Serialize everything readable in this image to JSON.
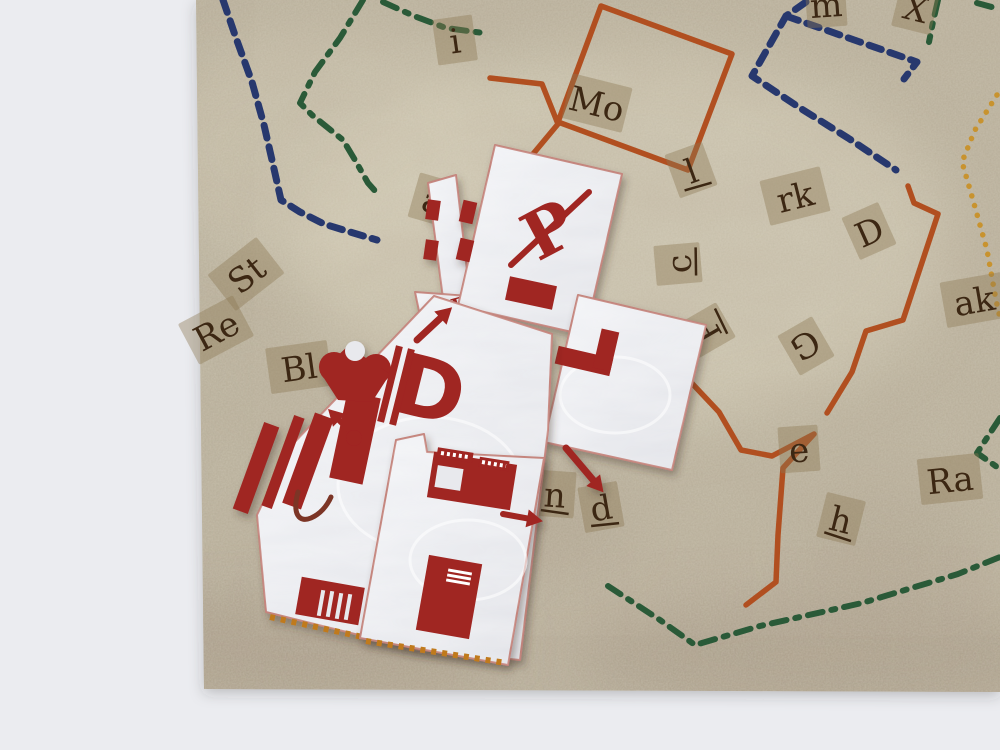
{
  "scene": {
    "description": "Photograph of a parchment treasure-map game board with colored route lines and cut-out letter tiles, overlaid with white papercraft puzzle pieces printed with dark red robot motifs, lying on a light gray table surface."
  },
  "colors": {
    "backdrop": "#ebecf0",
    "parchment": "#b7ae99",
    "parchment_light": "#d8d1bb",
    "shade": "#8d7c69",
    "tile_bg": "rgba(141,120,82,0.40)",
    "tile_text": "#3c2713",
    "piece_base": "#e8e9ed",
    "piece_edge": "#c4847c",
    "print_red": "#a02521",
    "print_dark": "#7c3526",
    "green": "#2a5a38",
    "navy": "#27386e",
    "orange": "#b14f20",
    "yellow": "#c8932f",
    "perforation": "#c07a1e"
  },
  "map": {
    "outline": [
      [
        196,
        0
      ],
      [
        1000,
        0
      ],
      [
        1000,
        692
      ],
      [
        204,
        689
      ]
    ],
    "shade_band": [
      [
        204,
        552
      ],
      [
        1000,
        545
      ],
      [
        1000,
        692
      ],
      [
        204,
        689
      ]
    ],
    "letter_tiles": [
      {
        "label": "m",
        "x": 826,
        "y": 4,
        "rot": -4
      },
      {
        "label": "X",
        "x": 916,
        "y": 8,
        "rot": 14
      },
      {
        "label": "i",
        "x": 455,
        "y": 40,
        "rot": -8
      },
      {
        "label": "Mo",
        "x": 597,
        "y": 103,
        "rot": 14
      },
      {
        "label": "l",
        "x": 691,
        "y": 170,
        "rot": -20,
        "ul": true
      },
      {
        "label": "rk",
        "x": 795,
        "y": 196,
        "rot": -14
      },
      {
        "label": "D",
        "x": 869,
        "y": 231,
        "rot": -24
      },
      {
        "label": "c",
        "x": 678,
        "y": 264,
        "rot": -95,
        "ul": true
      },
      {
        "label": "P",
        "x": 706,
        "y": 331,
        "rot": -120,
        "ul": true
      },
      {
        "label": "G",
        "x": 806,
        "y": 346,
        "rot": 150
      },
      {
        "label": "ak",
        "x": 974,
        "y": 300,
        "rot": -10
      },
      {
        "label": "a",
        "x": 433,
        "y": 200,
        "rot": 16
      },
      {
        "label": "St",
        "x": 246,
        "y": 274,
        "rot": -38
      },
      {
        "label": "Re",
        "x": 216,
        "y": 330,
        "rot": -28
      },
      {
        "label": "Bl",
        "x": 299,
        "y": 367,
        "rot": -8
      },
      {
        "label": "x",
        "x": 620,
        "y": 341,
        "rot": 36
      },
      {
        "label": "n",
        "x": 555,
        "y": 494,
        "rot": 4,
        "ul": true
      },
      {
        "label": "d",
        "x": 601,
        "y": 507,
        "rot": -10,
        "ul": true
      },
      {
        "label": "e",
        "x": 799,
        "y": 449,
        "rot": -4
      },
      {
        "label": "h",
        "x": 841,
        "y": 519,
        "rot": 14,
        "ul": true
      },
      {
        "label": "Ra",
        "x": 950,
        "y": 479,
        "rot": -6
      }
    ]
  },
  "paths": [
    {
      "name": "route-green-dashdot-a",
      "color": "green",
      "style": "dashdot",
      "w": 6,
      "pts": [
        [
          363,
          0
        ],
        [
          340,
          38
        ],
        [
          315,
          72
        ],
        [
          300,
          103
        ],
        [
          312,
          115
        ],
        [
          343,
          140
        ],
        [
          355,
          160
        ],
        [
          368,
          183
        ],
        [
          376,
          192
        ]
      ]
    },
    {
      "name": "route-green-dashdot-b",
      "color": "green",
      "style": "dashdot",
      "w": 6,
      "pts": [
        [
          383,
          2
        ],
        [
          414,
          16
        ],
        [
          446,
          28
        ],
        [
          483,
          33
        ]
      ]
    },
    {
      "name": "route-green-dashdot-c",
      "color": "green",
      "style": "dashdot",
      "w": 6,
      "pts": [
        [
          938,
          0
        ],
        [
          933,
          22
        ],
        [
          929,
          42
        ]
      ]
    },
    {
      "name": "route-green-dashdot-d",
      "color": "green",
      "style": "dashdot",
      "w": 6,
      "pts": [
        [
          977,
          3
        ],
        [
          999,
          9
        ]
      ]
    },
    {
      "name": "route-green-dashdot-e",
      "color": "green",
      "style": "dashdot",
      "w": 6,
      "pts": [
        [
          1000,
          418
        ],
        [
          977,
          453
        ],
        [
          997,
          467
        ]
      ]
    },
    {
      "name": "route-green-dashdot-f",
      "color": "green",
      "style": "dashdot",
      "w": 6,
      "pts": [
        [
          608,
          586
        ],
        [
          660,
          620
        ],
        [
          695,
          645
        ],
        [
          760,
          626
        ],
        [
          862,
          603
        ],
        [
          958,
          574
        ],
        [
          1000,
          557
        ]
      ]
    },
    {
      "name": "route-navy-dashed-a",
      "color": "navy",
      "style": "dashed",
      "w": 7,
      "pts": [
        [
          223,
          0
        ],
        [
          236,
          38
        ],
        [
          252,
          82
        ],
        [
          264,
          125
        ],
        [
          272,
          160
        ],
        [
          281,
          200
        ],
        [
          300,
          212
        ],
        [
          324,
          224
        ],
        [
          350,
          232
        ],
        [
          377,
          240
        ]
      ]
    },
    {
      "name": "route-navy-dashed-b",
      "color": "navy",
      "style": "dashed",
      "w": 7,
      "pts": [
        [
          806,
          2
        ],
        [
          786,
          16
        ],
        [
          752,
          76
        ],
        [
          800,
          108
        ],
        [
          848,
          138
        ],
        [
          896,
          170
        ]
      ]
    },
    {
      "name": "route-navy-dashed-c",
      "color": "navy",
      "style": "dashed",
      "w": 7,
      "pts": [
        [
          786,
          16
        ],
        [
          860,
          42
        ],
        [
          917,
          62
        ],
        [
          904,
          79
        ]
      ]
    },
    {
      "name": "route-orange-square",
      "color": "orange",
      "style": "solid",
      "w": 5.5,
      "pts": [
        [
          601,
          6
        ],
        [
          732,
          54
        ],
        [
          688,
          170
        ],
        [
          558,
          122
        ],
        [
          601,
          6
        ]
      ]
    },
    {
      "name": "route-orange-trail",
      "color": "orange",
      "style": "solid",
      "w": 5.5,
      "pts": [
        [
          490,
          78
        ],
        [
          542,
          84
        ],
        [
          558,
          124
        ],
        [
          518,
          172
        ],
        [
          548,
          262
        ],
        [
          588,
          327
        ],
        [
          648,
          341
        ],
        [
          672,
          347
        ],
        [
          686,
          377
        ],
        [
          719,
          412
        ],
        [
          741,
          450
        ],
        [
          772,
          456
        ],
        [
          814,
          434
        ],
        [
          783,
          468
        ],
        [
          778,
          535
        ],
        [
          776,
          582
        ],
        [
          746,
          605
        ]
      ]
    },
    {
      "name": "route-orange-zigzag",
      "color": "orange",
      "style": "solid",
      "w": 5.5,
      "pts": [
        [
          908,
          186
        ],
        [
          914,
          203
        ],
        [
          938,
          214
        ],
        [
          903,
          320
        ],
        [
          866,
          331
        ],
        [
          852,
          372
        ],
        [
          827,
          413
        ]
      ]
    },
    {
      "name": "route-yellow-dotted",
      "color": "yellow",
      "style": "dotted",
      "w": 5.5,
      "pts": [
        [
          997,
          95
        ],
        [
          975,
          130
        ],
        [
          962,
          162
        ],
        [
          973,
          200
        ],
        [
          987,
          250
        ],
        [
          996,
          300
        ],
        [
          1000,
          318
        ]
      ]
    }
  ],
  "pieces": [
    {
      "name": "paper-piece-sliver",
      "outline": [
        [
          428,
          183
        ],
        [
          456,
          175
        ],
        [
          470,
          296
        ],
        [
          444,
          306
        ]
      ],
      "decals": [
        {
          "n": "edge-notch",
          "t": "rect",
          "x": 433,
          "y": 210,
          "w": 13,
          "h": 20,
          "r": 8
        },
        {
          "n": "edge-notch",
          "t": "rect",
          "x": 431,
          "y": 250,
          "w": 13,
          "h": 20,
          "r": 8
        }
      ]
    },
    {
      "name": "paper-piece-e-flap",
      "outline": [
        [
          415,
          292
        ],
        [
          468,
          296
        ],
        [
          448,
          324
        ],
        [
          420,
          316
        ]
      ],
      "decals": [
        {
          "n": "letter-e-mark",
          "t": "text",
          "s": "E",
          "x": 459,
          "y": 305,
          "size": 21,
          "r": -15,
          "fam": "serif"
        }
      ]
    },
    {
      "name": "paper-piece-head",
      "outline": [
        [
          495,
          145
        ],
        [
          622,
          174
        ],
        [
          585,
          335
        ],
        [
          458,
          306
        ]
      ],
      "decals": [
        {
          "n": "crossed-p-symbol",
          "t": "text",
          "s": "P",
          "x": 549,
          "y": 230,
          "size": 66,
          "r": -28,
          "fam": "serif"
        },
        {
          "n": "crossed-p-slash",
          "t": "line",
          "x1": 511,
          "y1": 265,
          "x2": 589,
          "y2": 192,
          "w": 6
        },
        {
          "n": "red-bar-print",
          "t": "rect",
          "x": 531,
          "y": 293,
          "w": 48,
          "h": 24,
          "r": 12
        },
        {
          "n": "edge-notch",
          "t": "rect",
          "x": 468,
          "y": 212,
          "w": 14,
          "h": 22,
          "r": 13
        },
        {
          "n": "edge-notch",
          "t": "rect",
          "x": 465,
          "y": 250,
          "w": 14,
          "h": 22,
          "r": 13
        }
      ]
    },
    {
      "name": "paper-piece-right-arm",
      "outline": [
        [
          578,
          295
        ],
        [
          706,
          325
        ],
        [
          672,
          470
        ],
        [
          544,
          442
        ]
      ],
      "decals": [
        {
          "n": "crease-mark",
          "t": "ellipse",
          "x": 615,
          "y": 395,
          "rx": 55,
          "ry": 38
        },
        {
          "n": "corner-bar-horizontal",
          "t": "rect",
          "x": 584,
          "y": 361,
          "w": 56,
          "h": 18,
          "r": 13
        },
        {
          "n": "corner-bar-vertical",
          "t": "rect",
          "x": 606,
          "y": 350,
          "w": 18,
          "h": 40,
          "r": 13
        },
        {
          "n": "arrow-down-right-icon",
          "t": "arrow",
          "x1": 566,
          "y1": 448,
          "x2": 599,
          "y2": 487,
          "w": 7
        }
      ]
    },
    {
      "name": "paper-piece-torso",
      "outline": [
        [
          434,
          296
        ],
        [
          552,
          334
        ],
        [
          548,
          430
        ],
        [
          520,
          660
        ],
        [
          420,
          650
        ],
        [
          266,
          612
        ],
        [
          257,
          515
        ],
        [
          290,
          447
        ]
      ],
      "decals": [
        {
          "n": "crease-mark",
          "t": "ellipse",
          "x": 430,
          "y": 485,
          "rx": 92,
          "ry": 68
        },
        {
          "n": "wrench-stem",
          "t": "rect",
          "x": 355,
          "y": 438,
          "w": 34,
          "h": 88,
          "r": 12
        },
        {
          "n": "wrench-prong",
          "t": "circle",
          "x": 334,
          "y": 367,
          "rad": 15
        },
        {
          "n": "wrench-prong",
          "t": "circle",
          "x": 376,
          "y": 369,
          "rad": 15
        },
        {
          "n": "wrench-head",
          "t": "poly",
          "pts": [
            [
              320,
              372
            ],
            [
              348,
              346
            ],
            [
              390,
              374
            ],
            [
              372,
              402
            ],
            [
              338,
              400
            ]
          ]
        },
        {
          "n": "wrench-notch",
          "t": "circle",
          "x": 355,
          "y": 351,
          "rad": 10,
          "f": "piece"
        },
        {
          "n": "letter-d-print",
          "t": "text",
          "s": "D",
          "x": 430,
          "y": 390,
          "size": 84,
          "r": 14,
          "fam": "sans"
        },
        {
          "n": "d-bar",
          "t": "rect",
          "x": 390,
          "y": 384,
          "w": 7,
          "h": 78,
          "r": 14
        },
        {
          "n": "d-bar",
          "t": "rect",
          "x": 402,
          "y": 387,
          "w": 7,
          "h": 78,
          "r": 14
        },
        {
          "n": "arrow-up-right-icon",
          "t": "arrow",
          "x1": 417,
          "y1": 340,
          "x2": 447,
          "y2": 312,
          "w": 7
        },
        {
          "n": "arrow-up-left-icon",
          "t": "arrow",
          "x1": 352,
          "y1": 433,
          "x2": 333,
          "y2": 414,
          "w": 6
        },
        {
          "n": "arrow-blob",
          "t": "circle",
          "x": 354,
          "y": 438,
          "rad": 8
        },
        {
          "n": "diagonal-stripe",
          "t": "rect",
          "x": 256,
          "y": 468,
          "w": 16,
          "h": 92,
          "r": 20
        },
        {
          "n": "diagonal-stripe",
          "t": "rect",
          "x": 283,
          "y": 462,
          "w": 11,
          "h": 96,
          "r": 20
        },
        {
          "n": "diagonal-stripe",
          "t": "rect",
          "x": 308,
          "y": 461,
          "w": 20,
          "h": 96,
          "r": 20
        },
        {
          "n": "squiggle-mark",
          "t": "path",
          "d": "M 298,492 C 292,514 299,523 311,518 C 320,514 327,506 331,497",
          "f": "dark",
          "w": 5
        },
        {
          "n": "grille-print",
          "t": "rect",
          "x": 330,
          "y": 601,
          "w": 64,
          "h": 38,
          "r": 10
        },
        {
          "n": "grille-slot",
          "t": "rect",
          "x": 321,
          "y": 603,
          "w": 4,
          "h": 26,
          "r": 10,
          "f": "piece"
        },
        {
          "n": "grille-slot",
          "t": "rect",
          "x": 330,
          "y": 604,
          "w": 4,
          "h": 26,
          "r": 10,
          "f": "piece"
        },
        {
          "n": "grille-slot",
          "t": "rect",
          "x": 339,
          "y": 606,
          "w": 4,
          "h": 26,
          "r": 10,
          "f": "piece"
        },
        {
          "n": "grille-slot",
          "t": "rect",
          "x": 348,
          "y": 607,
          "w": 4,
          "h": 26,
          "r": 10,
          "f": "piece"
        },
        {
          "n": "fold-tab-dots",
          "t": "dots",
          "x1": 270,
          "y1": 617,
          "x2": 418,
          "y2": 649
        }
      ]
    },
    {
      "name": "paper-piece-legs",
      "outline": [
        [
          396,
          440
        ],
        [
          424,
          434
        ],
        [
          427,
          452
        ],
        [
          544,
          458
        ],
        [
          508,
          665
        ],
        [
          360,
          638
        ]
      ],
      "decals": [
        {
          "n": "crease-mark",
          "t": "ellipse",
          "x": 468,
          "y": 560,
          "rx": 58,
          "ry": 40
        },
        {
          "n": "machine-print-body",
          "t": "rect",
          "x": 472,
          "y": 481,
          "w": 84,
          "h": 46,
          "r": 9
        },
        {
          "n": "machine-window",
          "t": "rect",
          "x": 449,
          "y": 478,
          "w": 26,
          "h": 22,
          "r": 9,
          "f": "piece"
        },
        {
          "n": "machine-tab",
          "t": "rect",
          "x": 455,
          "y": 455,
          "w": 36,
          "h": 10,
          "r": 9
        },
        {
          "n": "machine-tab",
          "t": "rect",
          "x": 494,
          "y": 464,
          "w": 30,
          "h": 10,
          "r": 9
        },
        {
          "n": "machine-tab-dot-row",
          "t": "wdots",
          "x1": 441,
          "y1": 453,
          "x2": 468,
          "y2": 457
        },
        {
          "n": "machine-tab-dot-row",
          "t": "wdots",
          "x1": 482,
          "y1": 462,
          "x2": 506,
          "y2": 466
        },
        {
          "n": "arrow-right-icon",
          "t": "arrow",
          "x1": 503,
          "y1": 514,
          "x2": 536,
          "y2": 520,
          "w": 6
        },
        {
          "n": "boot-print",
          "t": "rect",
          "x": 449,
          "y": 597,
          "w": 54,
          "h": 76,
          "r": 10
        },
        {
          "n": "boot-hash",
          "t": "rect",
          "x": 460,
          "y": 572,
          "w": 24,
          "h": 3,
          "r": 10,
          "f": "white"
        },
        {
          "n": "boot-hash",
          "t": "rect",
          "x": 459,
          "y": 577,
          "w": 24,
          "h": 3,
          "r": 10,
          "f": "white"
        },
        {
          "n": "boot-hash",
          "t": "rect",
          "x": 458,
          "y": 582,
          "w": 24,
          "h": 3,
          "r": 10,
          "f": "white"
        },
        {
          "n": "fold-tab-dots",
          "t": "dots",
          "x1": 366,
          "y1": 641,
          "x2": 506,
          "y2": 663
        }
      ]
    }
  ]
}
